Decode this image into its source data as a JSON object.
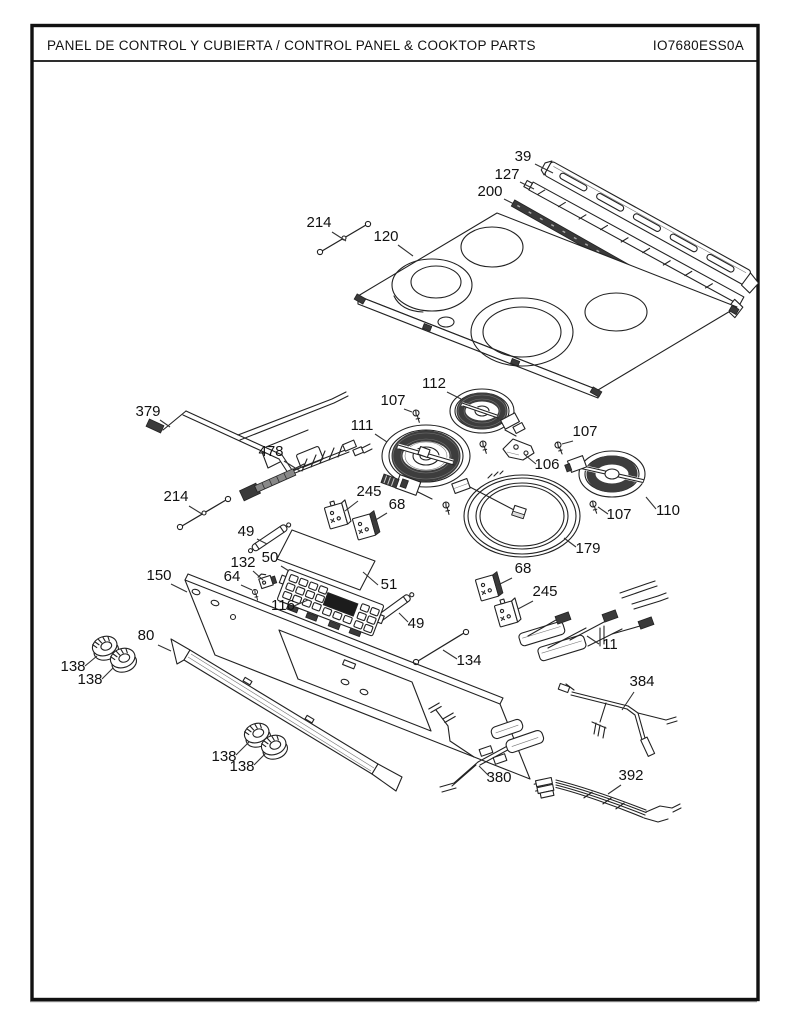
{
  "header": {
    "title": "PANEL DE CONTROL Y CUBIERTA / CONTROL PANEL & COOKTOP PARTS",
    "doc_number": "IO7680ESS0A"
  },
  "diagram": {
    "ink_color": "#222222",
    "callouts": [
      {
        "id": "39",
        "label": "39",
        "x": 523,
        "y": 161,
        "leader": [
          535,
          164,
          553,
          173
        ]
      },
      {
        "id": "127",
        "label": "127",
        "x": 507,
        "y": 179,
        "leader": [
          520,
          182,
          534,
          189
        ]
      },
      {
        "id": "200",
        "label": "200",
        "x": 490,
        "y": 196,
        "leader": [
          504,
          199,
          514,
          204
        ]
      },
      {
        "id": "214-top",
        "label": "214",
        "x": 319,
        "y": 227,
        "leader": [
          332,
          232,
          346,
          241
        ]
      },
      {
        "id": "120",
        "label": "120",
        "x": 386,
        "y": 241,
        "leader": [
          398,
          245,
          413,
          256
        ]
      },
      {
        "id": "112",
        "label": "112",
        "x": 434,
        "y": 388,
        "leader": [
          447,
          392,
          461,
          399
        ]
      },
      {
        "id": "107-a",
        "label": "107",
        "x": 393,
        "y": 405,
        "leader": [
          404,
          409,
          412,
          412
        ]
      },
      {
        "id": "111",
        "label": "111",
        "x": 362,
        "y": 430,
        "leader": [
          375,
          434,
          387,
          442
        ]
      },
      {
        "id": "107-b",
        "label": "107",
        "x": 585,
        "y": 436,
        "leader": [
          573,
          441,
          562,
          444
        ]
      },
      {
        "id": "106",
        "label": "106",
        "x": 547,
        "y": 469,
        "leader": [
          536,
          464,
          525,
          455
        ]
      },
      {
        "id": "110",
        "label": "110",
        "x": 668,
        "y": 515,
        "leader": [
          656,
          509,
          646,
          497
        ]
      },
      {
        "id": "107-c",
        "label": "107",
        "x": 619,
        "y": 519,
        "leader": [
          608,
          514,
          598,
          507
        ]
      },
      {
        "id": "379",
        "label": "379",
        "x": 148,
        "y": 416,
        "leader": [
          160,
          420,
          170,
          427
        ]
      },
      {
        "id": "478",
        "label": "478",
        "x": 271,
        "y": 456,
        "leader": [
          284,
          461,
          300,
          471
        ]
      },
      {
        "id": "214-left",
        "label": "214",
        "x": 176,
        "y": 501,
        "leader": [
          189,
          506,
          202,
          514
        ]
      },
      {
        "id": "245-left",
        "label": "245",
        "x": 369,
        "y": 496,
        "leader": [
          358,
          501,
          345,
          511
        ]
      },
      {
        "id": "68-left",
        "label": "68",
        "x": 397,
        "y": 509,
        "leader": [
          387,
          513,
          374,
          521
        ]
      },
      {
        "id": "49-top",
        "label": "49",
        "x": 246,
        "y": 536,
        "leader": [
          257,
          539,
          267,
          544
        ]
      },
      {
        "id": "179",
        "label": "179",
        "x": 588,
        "y": 553,
        "leader": [
          576,
          547,
          564,
          538
        ]
      },
      {
        "id": "50",
        "label": "50",
        "x": 270,
        "y": 562,
        "leader": [
          281,
          566,
          289,
          571
        ]
      },
      {
        "id": "132",
        "label": "132",
        "x": 243,
        "y": 567,
        "leader": [
          253,
          571,
          263,
          580
        ]
      },
      {
        "id": "150",
        "label": "150",
        "x": 159,
        "y": 580,
        "leader": [
          171,
          584,
          187,
          592
        ]
      },
      {
        "id": "64",
        "label": "64",
        "x": 232,
        "y": 581,
        "leader": [
          241,
          585,
          252,
          590
        ]
      },
      {
        "id": "68-right",
        "label": "68",
        "x": 523,
        "y": 573,
        "leader": [
          512,
          578,
          498,
          585
        ]
      },
      {
        "id": "51",
        "label": "51",
        "x": 389,
        "y": 589,
        "leader": [
          378,
          585,
          363,
          572
        ]
      },
      {
        "id": "245-right",
        "label": "245",
        "x": 545,
        "y": 596,
        "leader": [
          533,
          601,
          518,
          609
        ]
      },
      {
        "id": "116",
        "label": "116",
        "x": 283,
        "y": 610,
        "leader": [
          294,
          606,
          308,
          600
        ]
      },
      {
        "id": "49-bottom",
        "label": "49",
        "x": 416,
        "y": 628,
        "leader": [
          408,
          622,
          399,
          613
        ]
      },
      {
        "id": "11",
        "label": "11",
        "x": 610,
        "y": 649,
        "leader": [
          599,
          644,
          587,
          636
        ]
      },
      {
        "id": "80",
        "label": "80",
        "x": 146,
        "y": 640,
        "leader": [
          158,
          645,
          171,
          651
        ]
      },
      {
        "id": "134",
        "label": "134",
        "x": 469,
        "y": 665,
        "leader": [
          457,
          659,
          443,
          650
        ]
      },
      {
        "id": "138-a",
        "label": "138",
        "x": 73,
        "y": 671,
        "leader": [
          85,
          666,
          97,
          656
        ]
      },
      {
        "id": "138-b",
        "label": "138",
        "x": 90,
        "y": 684,
        "leader": [
          102,
          679,
          113,
          668
        ]
      },
      {
        "id": "384",
        "label": "384",
        "x": 642,
        "y": 686,
        "leader": [
          634,
          692,
          622,
          710
        ]
      },
      {
        "id": "138-c",
        "label": "138",
        "x": 224,
        "y": 761,
        "leader": [
          236,
          755,
          249,
          742
        ]
      },
      {
        "id": "138-d",
        "label": "138",
        "x": 242,
        "y": 771,
        "leader": [
          254,
          765,
          266,
          753
        ]
      },
      {
        "id": "380",
        "label": "380",
        "x": 499,
        "y": 782,
        "leader": [
          489,
          776,
          479,
          766
        ]
      },
      {
        "id": "392",
        "label": "392",
        "x": 631,
        "y": 780,
        "leader": [
          621,
          785,
          608,
          794
        ]
      }
    ]
  }
}
